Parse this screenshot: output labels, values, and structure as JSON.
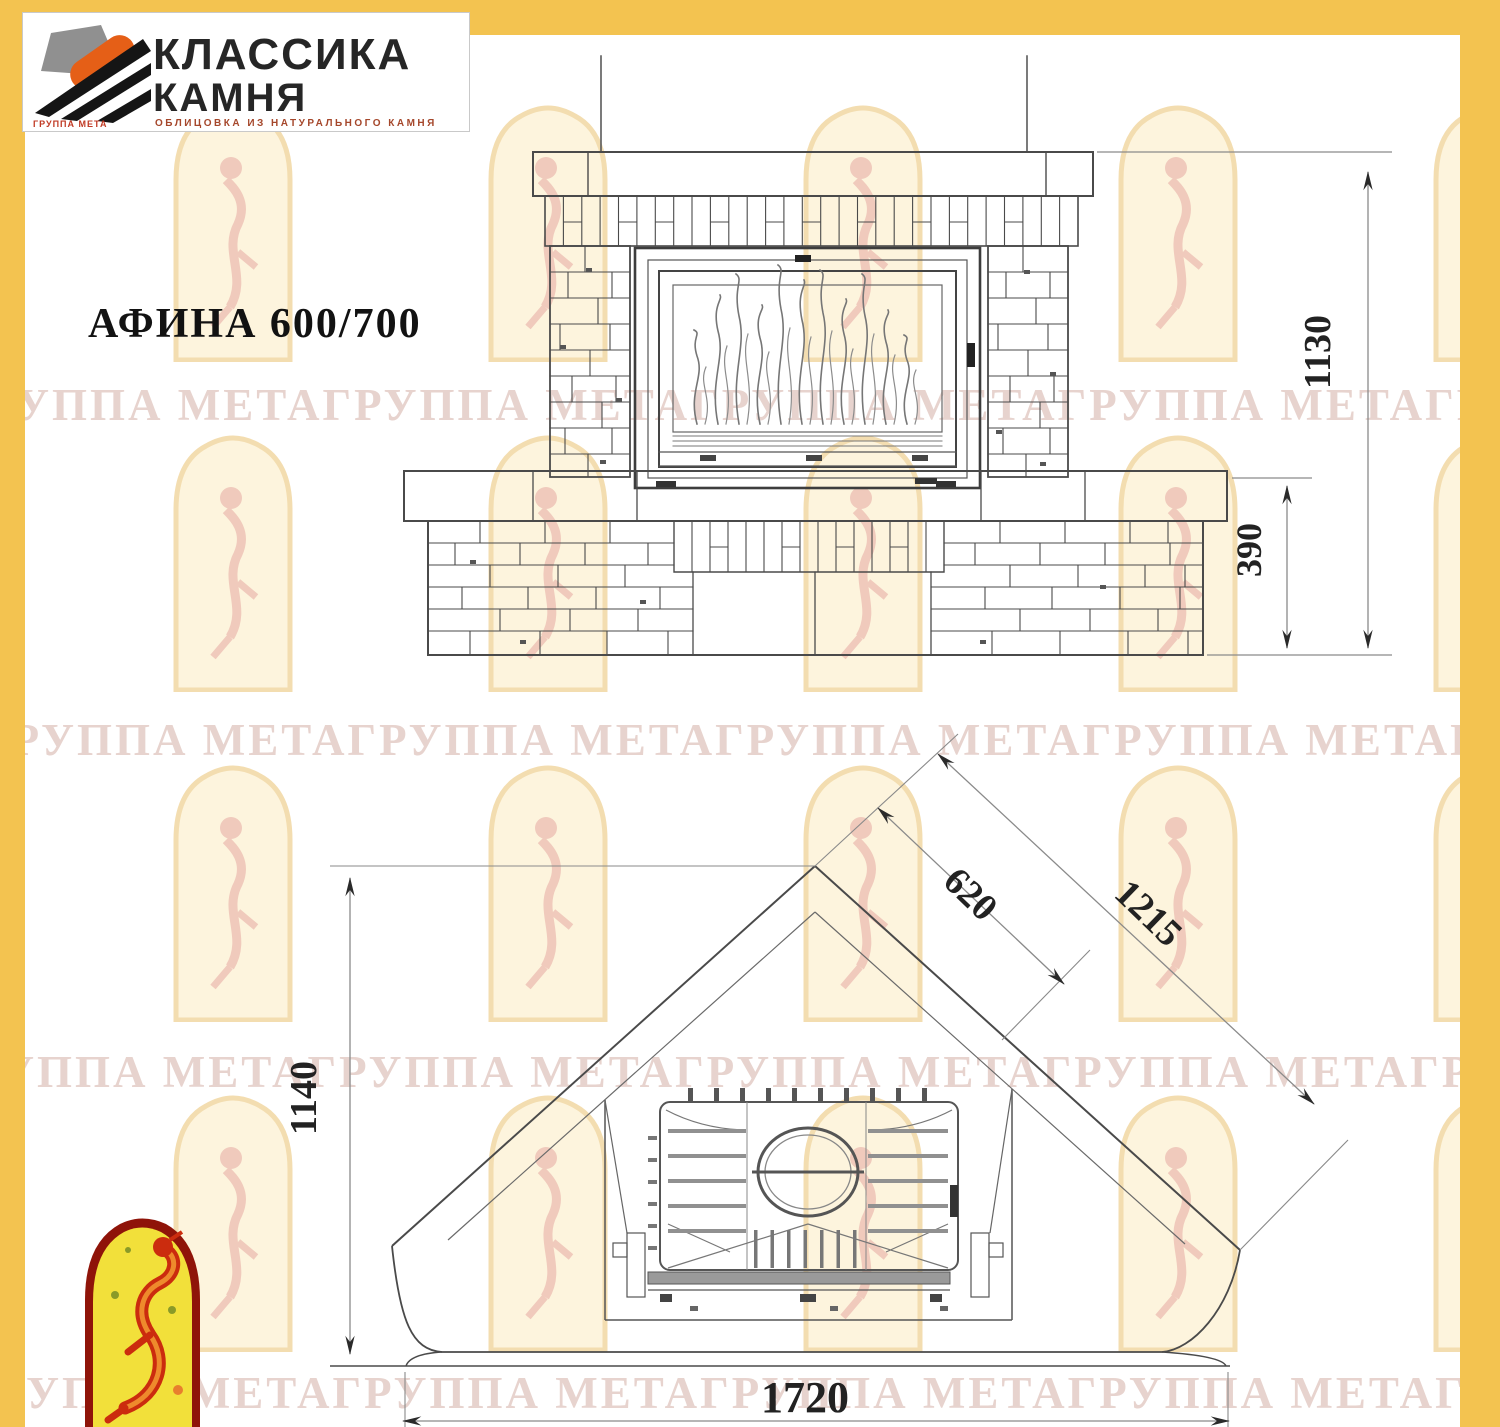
{
  "brand": {
    "line1": "КЛАССИКА",
    "line2": "КАМНЯ",
    "tagline": "ОБЛИЦОВКА ИЗ НАТУРАЛЬНОГО КАМНЯ",
    "sub_caption": "ГРУППА МЕТА"
  },
  "title": "АФИНА 600/700",
  "watermark": {
    "row_text": "ГРУППА МЕТАГРУППА МЕТАГРУППА МЕТАГРУППА МЕТАГРУППА МЕТА"
  },
  "dimensions": {
    "front_total_height": "1130",
    "front_base_height": "390",
    "plan_depth": "1140",
    "plan_front_width": "1720",
    "plan_diagonal_side": "1215",
    "plan_firebox_side": "620"
  },
  "colors": {
    "page_border": "#F3C350",
    "logo_orange": "#E55F17",
    "logo_gray": "#909090",
    "logo_black": "#151515",
    "emblem_border_red": "#8F1409",
    "emblem_yellow": "#F2E03A",
    "emblem_figure_red": "#CB2C0E"
  }
}
